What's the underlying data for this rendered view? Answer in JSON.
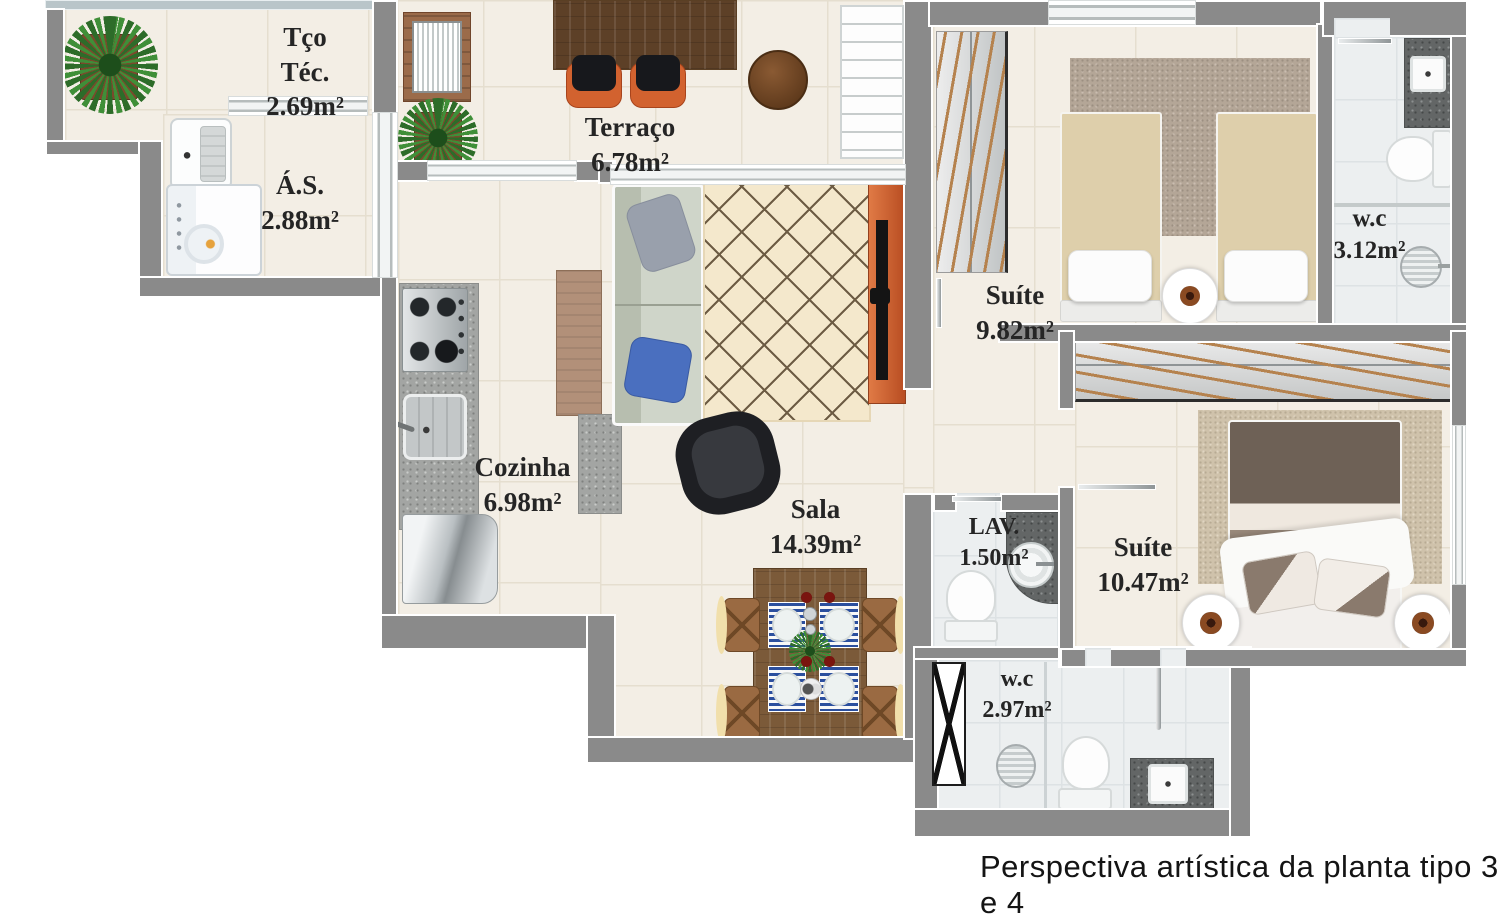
{
  "plan": {
    "caption": "Perspectiva artística da planta tipo 3 e 4",
    "rooms": {
      "tco_tec": {
        "name": "Tço\nTéc.",
        "area": "2.69m²"
      },
      "as": {
        "name": "Á.S.",
        "area": "2.88m²"
      },
      "terraco": {
        "name": "Terraço",
        "area": "6.78m²"
      },
      "suite1": {
        "name": "Suíte",
        "area": "9.82m²"
      },
      "wc1": {
        "name": "w.c",
        "area": "3.12m²"
      },
      "cozinha": {
        "name": "Cozinha",
        "area": "6.98m²"
      },
      "sala": {
        "name": "Sala",
        "area": "14.39m²"
      },
      "lav": {
        "name": "LAV.",
        "area": "1.50m²"
      },
      "suite2": {
        "name": "Suíte",
        "area": "10.47m²"
      },
      "wc2": {
        "name": "w.c",
        "area": "2.97m²"
      }
    },
    "colors": {
      "wall": "#8a8a8a",
      "floor_tile": "#f3eee5",
      "bath_tile": "#eceff0",
      "window_ledge": "#b9c5c9",
      "tv_panel_orange": "#d2622f",
      "wood_table": "#7b5a39",
      "sofa_sage": "#cdd3c7",
      "bed_beige": "#decfab",
      "duvet_brown": "#6e6156"
    }
  }
}
